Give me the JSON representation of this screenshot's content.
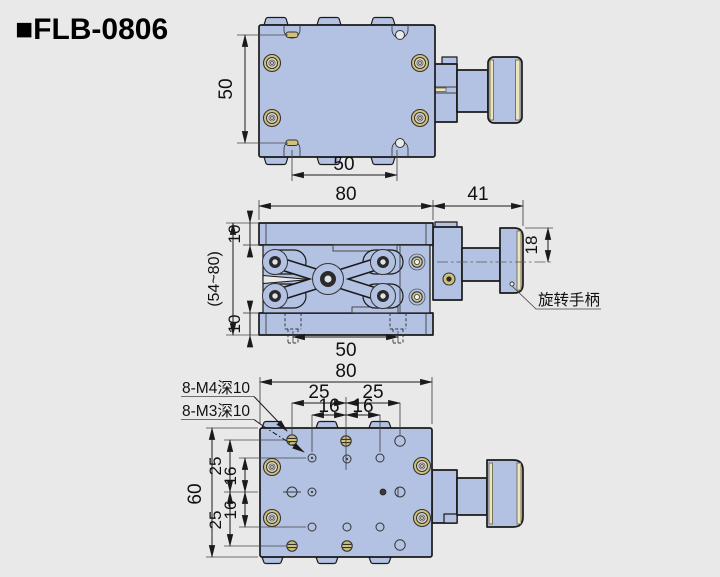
{
  "title": "■FLB-0806",
  "colors": {
    "background": "#e9e9e9",
    "body": "#b3c2e2",
    "outline": "#1a1a1a",
    "brass": "#d0c179",
    "cream": "#ece4bc"
  },
  "top_view": {
    "dim_vertical": "50",
    "dim_horizontal": "50"
  },
  "side_view": {
    "dim_width": "80",
    "dim_handle_len": "41",
    "dim_plate_top": "10",
    "dim_plate_bottom": "10",
    "dim_height_range": "(54~80)",
    "dim_handle_dia": "18",
    "dim_screw_spacing": "50",
    "label_handle": "旋转手柄"
  },
  "bottom_view": {
    "dim_width": "80",
    "dim_h25_left": "25",
    "dim_h25_right": "25",
    "dim_h16_left": "16",
    "dim_h16_right": "16",
    "dim_height": "60",
    "dim_v25_top": "25",
    "dim_v16_top": "16",
    "dim_v16_bottom": "16",
    "dim_v25_bottom": "25",
    "label_m4": "8-M4深10",
    "label_m3": "8-M3深10"
  }
}
